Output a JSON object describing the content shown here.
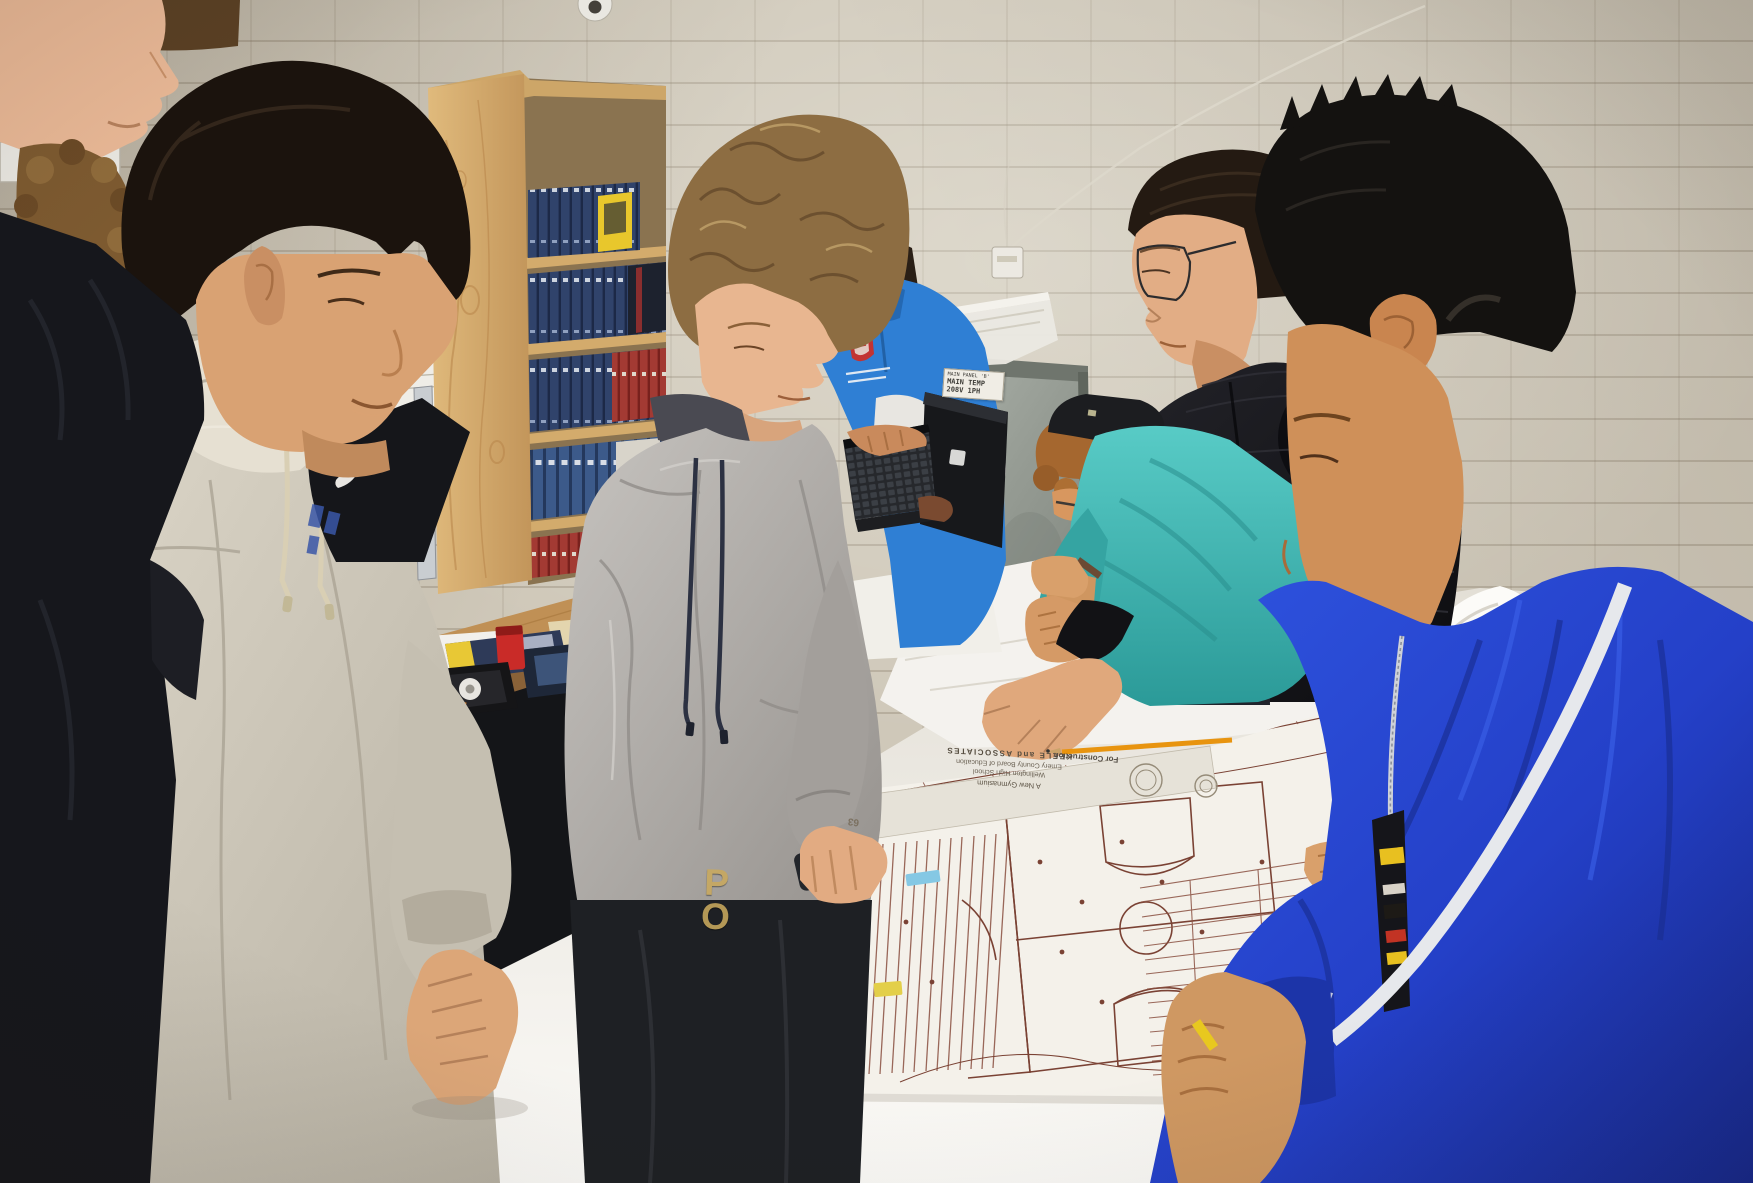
{
  "meta": {
    "type": "photograph",
    "setting": "Career-and-technical-education classroom with beige cinder-block walls",
    "description": "A group of high-school students and an instructor stand around a long table covered with white paper and large architectural blueprints of a gymnasium, studying the electrical plans. A plywood bookshelf full of navy code binders stands against the wall; the instructor in a blue polo types on a rugged laptop."
  },
  "visible_text": {
    "equipment_label": {
      "line1": "MAIN PANEL 'B'",
      "line2": "MAIN TEMP",
      "line3": "208V 1PH"
    },
    "blueprint_title_block": {
      "firm": "KEELE and ASSOCIATES",
      "client": "Emery County Board of Education",
      "project": "Wellington High School",
      "subject": "A New Gymnasium",
      "status": "For Construction",
      "sheet_number": "63"
    },
    "clothing": {
      "sweatpants_letters": "PO"
    }
  },
  "people": [
    {
      "id": "student-far-left",
      "description": "Partially cropped student at left edge, pale skin, dark navy hoodie, face in profile at top-left corner"
    },
    {
      "id": "student-curly",
      "description": "Student with light-brown curly hair behind the far-left student"
    },
    {
      "id": "student-cream-hoodie",
      "description": "Student with black bowl-cut hair, cream hoodie over black Nike tee, fist resting on table"
    },
    {
      "id": "student-gray-hoodie",
      "description": "Heavy-set student with sandy curly hair in heather-gray hoodie and black sweatpants, hand on phone over blueprint"
    },
    {
      "id": "instructor-blue-polo",
      "description": "Instructor in bright blue polo with red school crest, white under-sleeves, typing on a rugged black laptop"
    },
    {
      "id": "student-teal-shirt",
      "description": "Student in teal long-sleeve shirt and backwards black cap leaning far over the table"
    },
    {
      "id": "student-black-puffer",
      "description": "Tall student with glasses and dark hair in quilted black puffer jacket, pointing at the blueprint"
    },
    {
      "id": "student-blue-track-jacket",
      "description": "Student with spiky black hair in royal-blue track jacket with white sleeve stripe, holding a small yellow tool"
    }
  ],
  "objects": [
    "plywood bookshelf with rows of navy binders, one yellow book spine, red books",
    "wood-top desk with electrical code books, red power-tool battery, black parts tray, white tape roll, papers",
    "black cabinet with black trash bag",
    "galvanized sheet-metal electrical panel leaning on wall with white typed label",
    "white translucent storage bin on top of panel",
    "dome security camera at ceiling",
    "white thermostat box with thin cable on wall",
    "silver level leaning against bookshelf",
    "white sign sheet taped to wall",
    "rugged black laptop with white logo square",
    "large gymnasium electrical blueprint with two basketball courts, note column, schedule grid and title strip",
    "orange pencils, blue tape scrap, yellow highlighter mark, dark smartphone, yellow utility tool"
  ],
  "icons": [
    {
      "name": "security-camera-dome",
      "meaning": "ceiling security camera"
    },
    {
      "name": "school-crest-logo",
      "meaning": "red crest on instructor polo, caption illegible"
    },
    {
      "name": "nike-swoosh-logo",
      "meaning": "white swoosh on black tee"
    },
    {
      "name": "laptop-brand-logo",
      "meaning": "white square logo on laptop lid"
    }
  ],
  "palette": {
    "wall": "#cfc8b9",
    "mortar": "#7d705c",
    "shelf_wood": "#d9b375",
    "binder_navy": "#30436b",
    "accent_yellow": "#e8c72c",
    "book_red": "#a33a33",
    "desk_wood": "#c09055",
    "polo_blue": "#2f7fd4",
    "teal_shirt": "#3fbdba",
    "puffer_black": "#141417",
    "track_jacket_blue": "#2440c8",
    "stripe_white": "#e6e8ec",
    "cream_hoodie": "#cfc9bb",
    "gray_hoodie": "#b0aca8",
    "paper_white": "#f4f2ec",
    "blueprint_line": "#8a4f3f",
    "battery_red": "#c92b28",
    "pencil_orange": "#e8940f"
  }
}
